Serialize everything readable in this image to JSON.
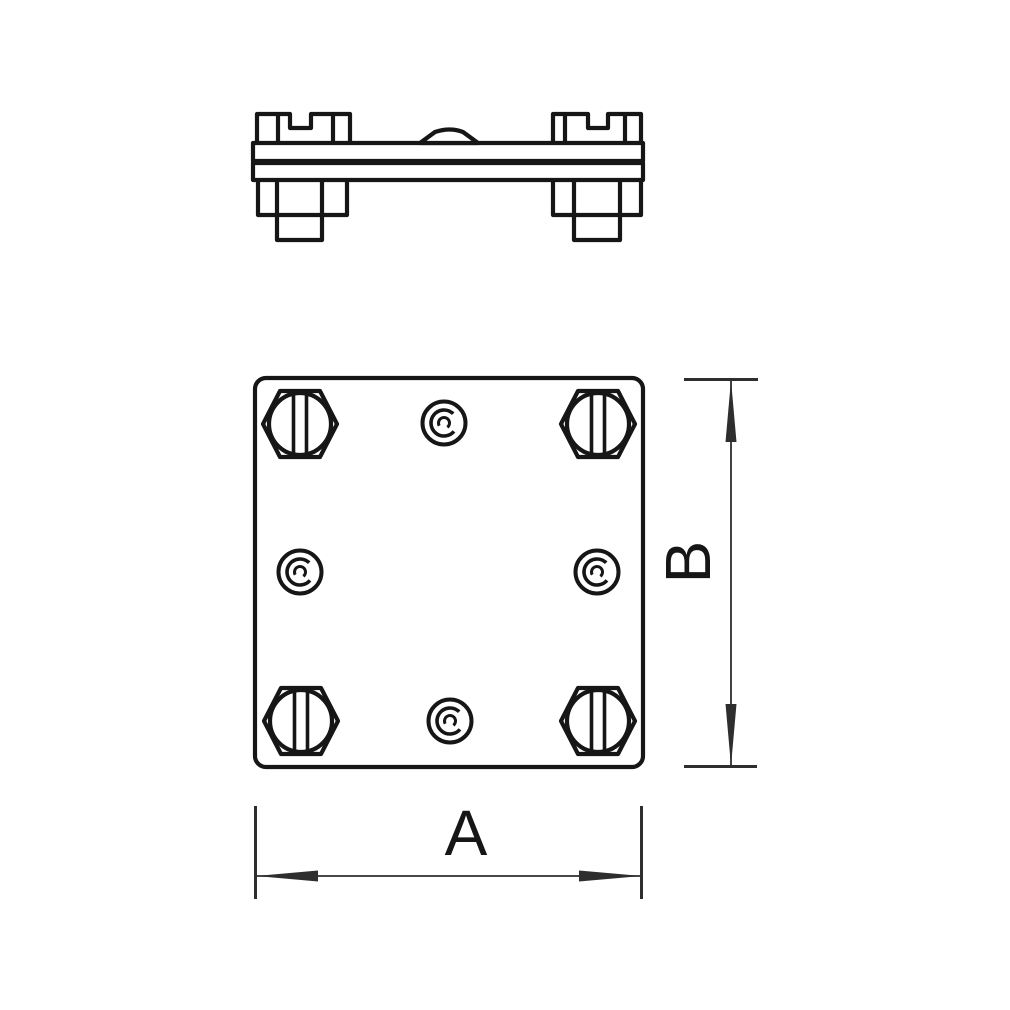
{
  "labels": {
    "dim_width": "A",
    "dim_height": "B"
  },
  "colors": {
    "ink": "#161616",
    "dim": "#2e2e2e",
    "background": "#ffffff"
  }
}
